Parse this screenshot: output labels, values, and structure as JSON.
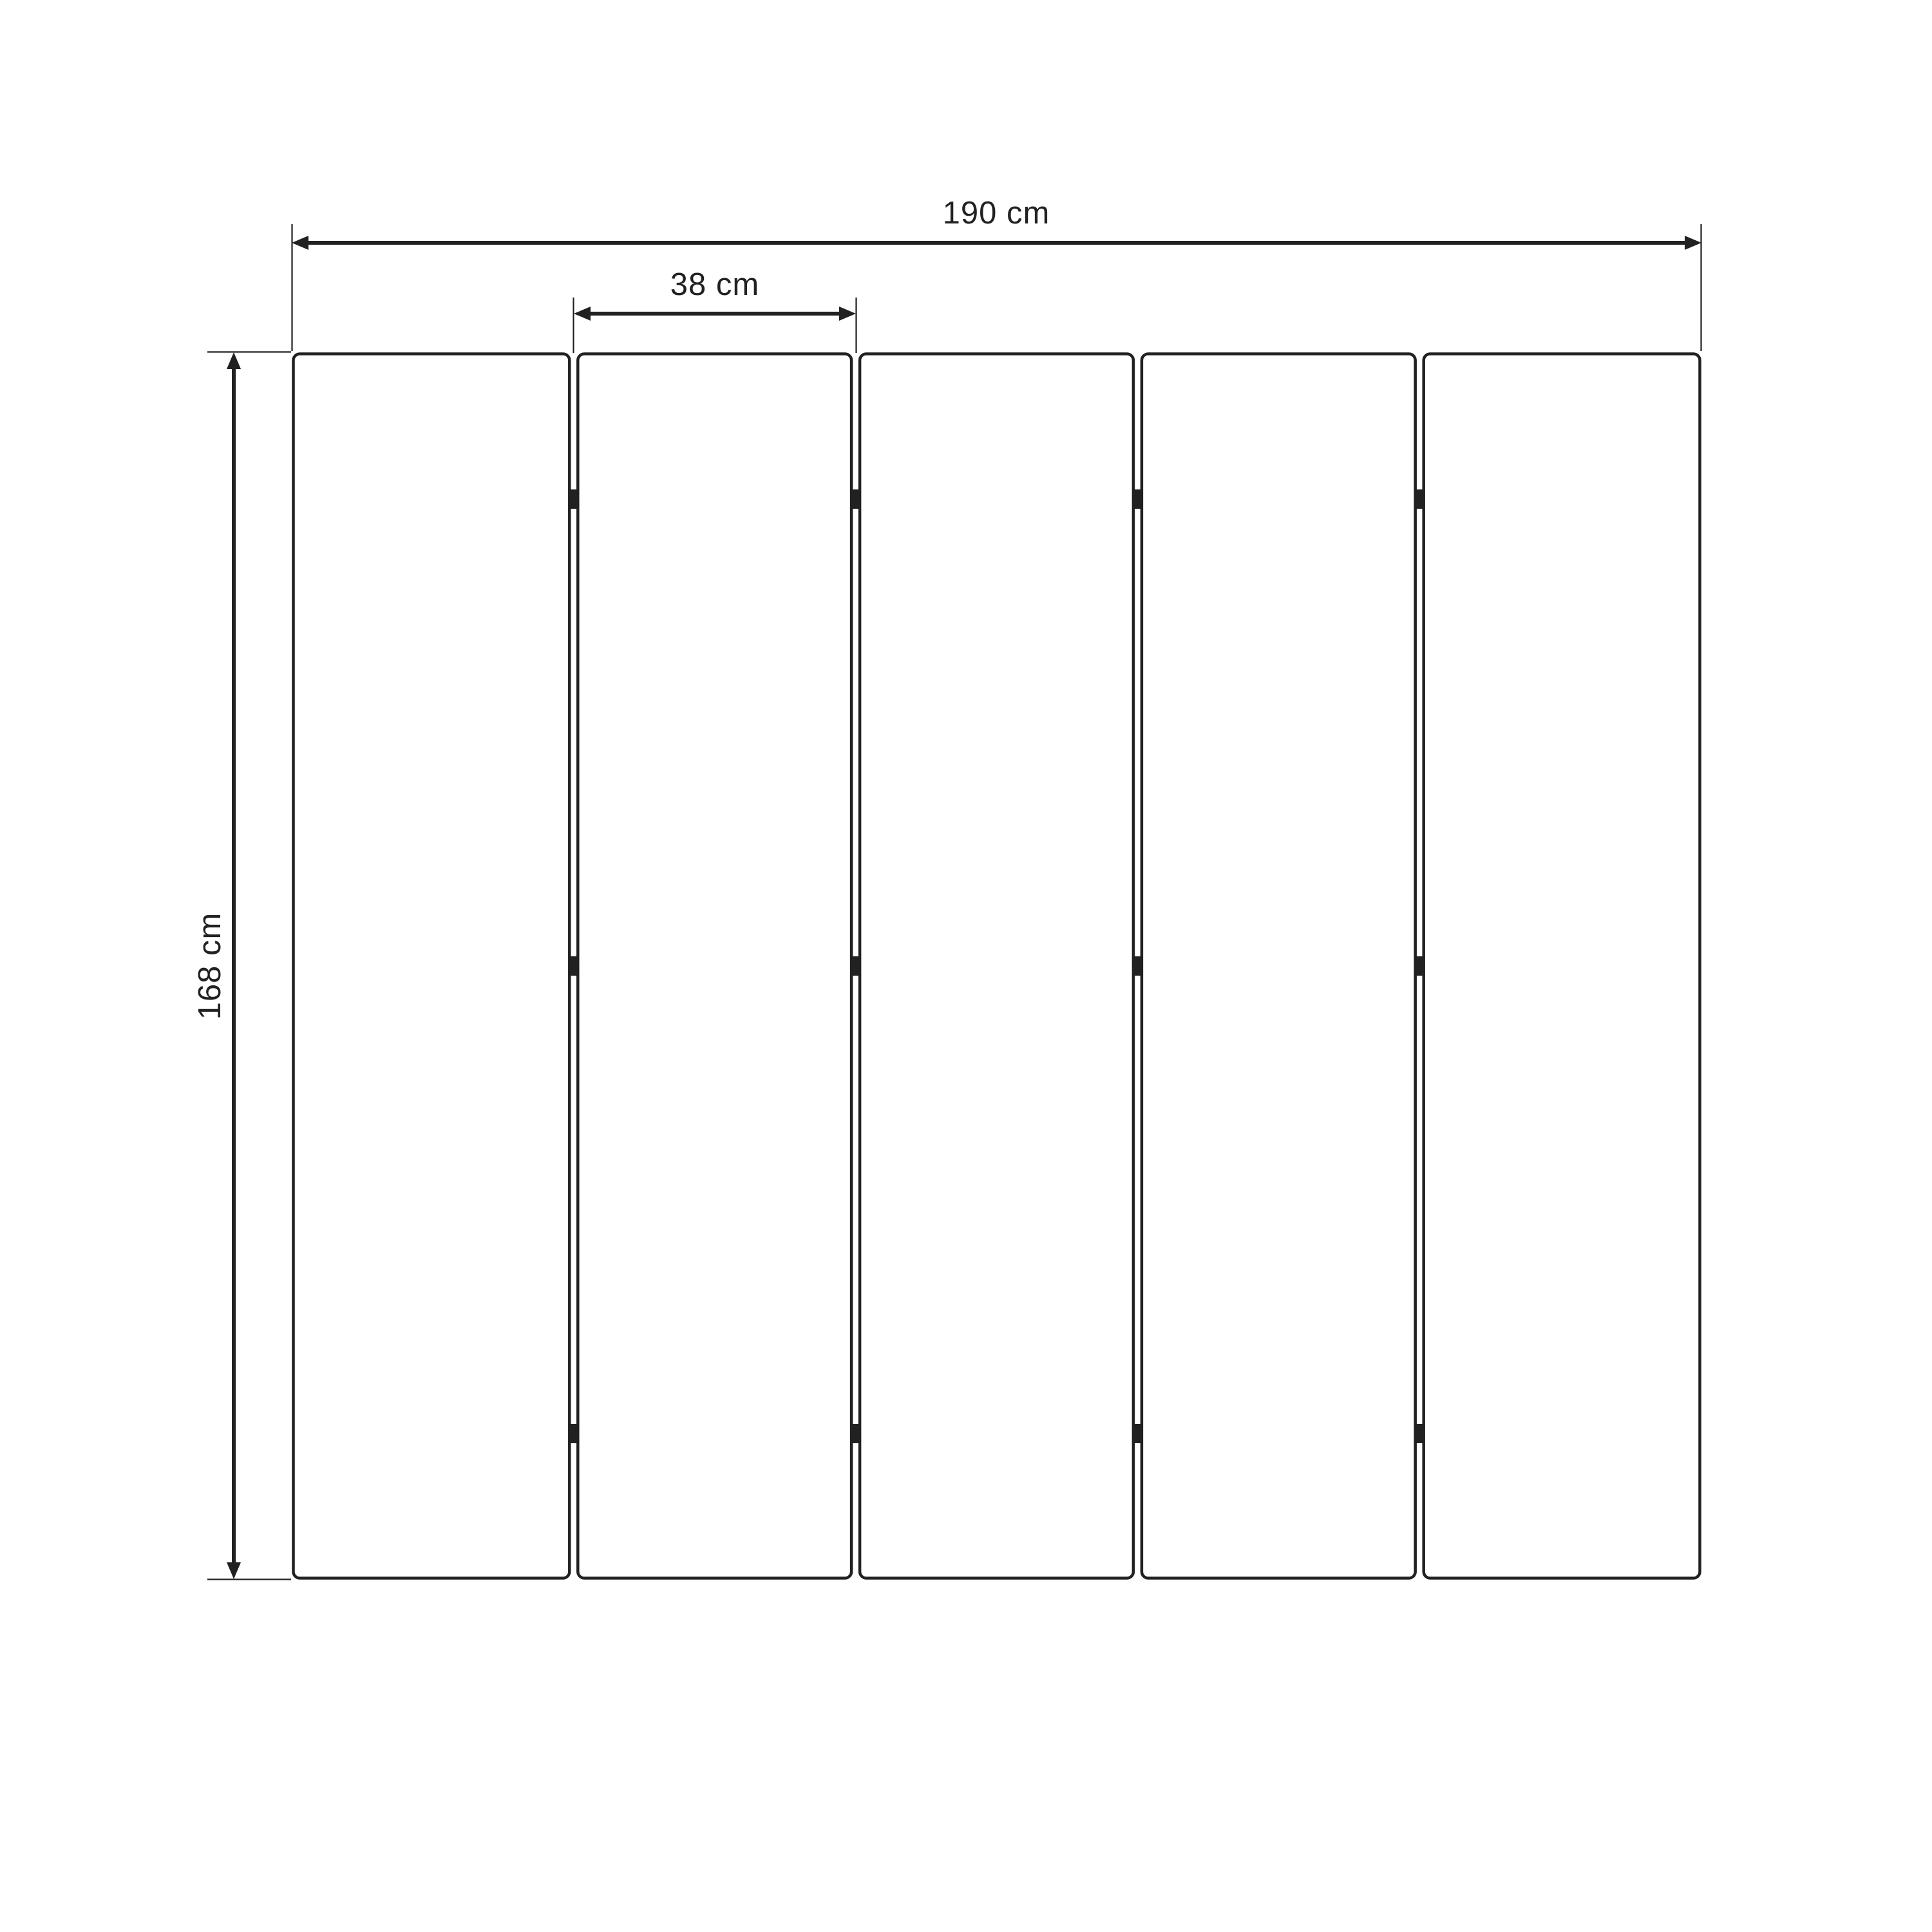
{
  "diagram": {
    "type": "dimension-drawing",
    "subject": "five-panel folding screen (room divider), front elevation",
    "panel_count": 5,
    "dimensions": {
      "total_width": {
        "label": "190 cm",
        "value": 190,
        "unit": "cm"
      },
      "panel_width": {
        "label": "38 cm",
        "value": 38,
        "unit": "cm"
      },
      "height": {
        "label": "168 cm",
        "value": 168,
        "unit": "cm"
      }
    },
    "hinges": {
      "gaps": 4,
      "per_gap": 3
    },
    "colors": {
      "ink": "#212121",
      "background": "#ffffff"
    }
  }
}
